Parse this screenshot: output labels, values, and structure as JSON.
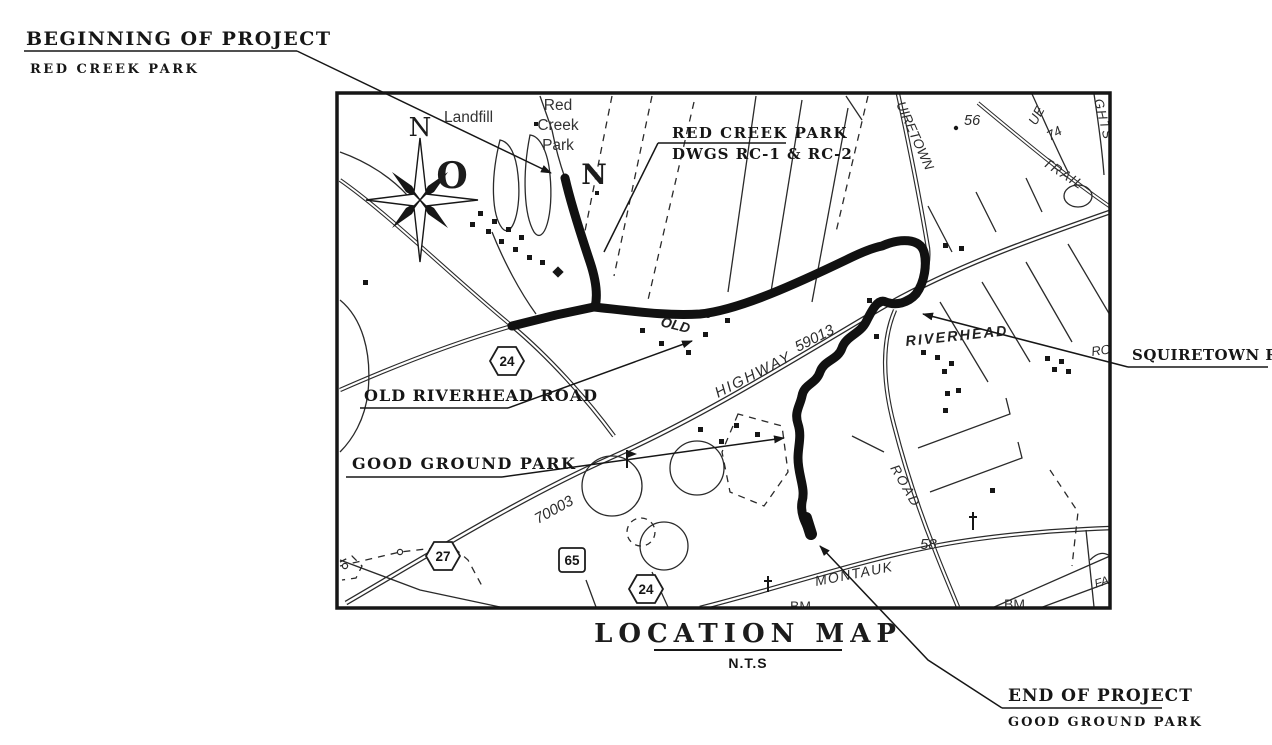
{
  "colors": {
    "ink": "#1d1d1d",
    "paper": "#ffffff",
    "route": "#111111"
  },
  "annotations": {
    "beginning": {
      "title": "BEGINNING OF PROJECT",
      "subtitle": "RED CREEK PARK"
    },
    "end": {
      "title": "END OF PROJECT",
      "subtitle": "GOOD GROUND PARK"
    },
    "squiretown": {
      "label": "SQUIRETOWN ROAD"
    },
    "old_riverhead": {
      "label": "OLD RIVERHEAD ROAD"
    },
    "good_ground": {
      "label": "GOOD GROUND PARK"
    },
    "red_creek_dwgs": {
      "line1": "RED CREEK PARK",
      "line2": "DWGS RC-1 & RC-2"
    }
  },
  "title_block": {
    "title": "LOCATION MAP",
    "scale": "N.T.S"
  },
  "map_labels": {
    "landfill": "Landfill",
    "red_creek_park": {
      "l1": "Red",
      "l2": "Creek",
      "l3": "Park"
    },
    "compass": {
      "n": "N",
      "o": "O"
    },
    "north_marker": "N",
    "roads": {
      "squiretown_partial": "UIRETOWN",
      "riverhead": "RIVERHEAD",
      "old": "OLD",
      "highway": "HIGHWAY",
      "montauk": "MONTAUK",
      "road": "ROAD",
      "trail": "TRAIL",
      "avenue_partial": "UE",
      "heights_partial": "GHTS",
      "ro_partial": "RO",
      "fa_partial": "FA"
    },
    "numbers": {
      "n56": "56",
      "n74": "74",
      "n58": "58",
      "hwy1": "59013",
      "hwy2": "70003"
    },
    "benchmarks": {
      "bm1": "BM",
      "bm2": "BM"
    },
    "shields": {
      "s24a": "24",
      "s27": "27",
      "s65": "65",
      "s24b": "24"
    }
  }
}
